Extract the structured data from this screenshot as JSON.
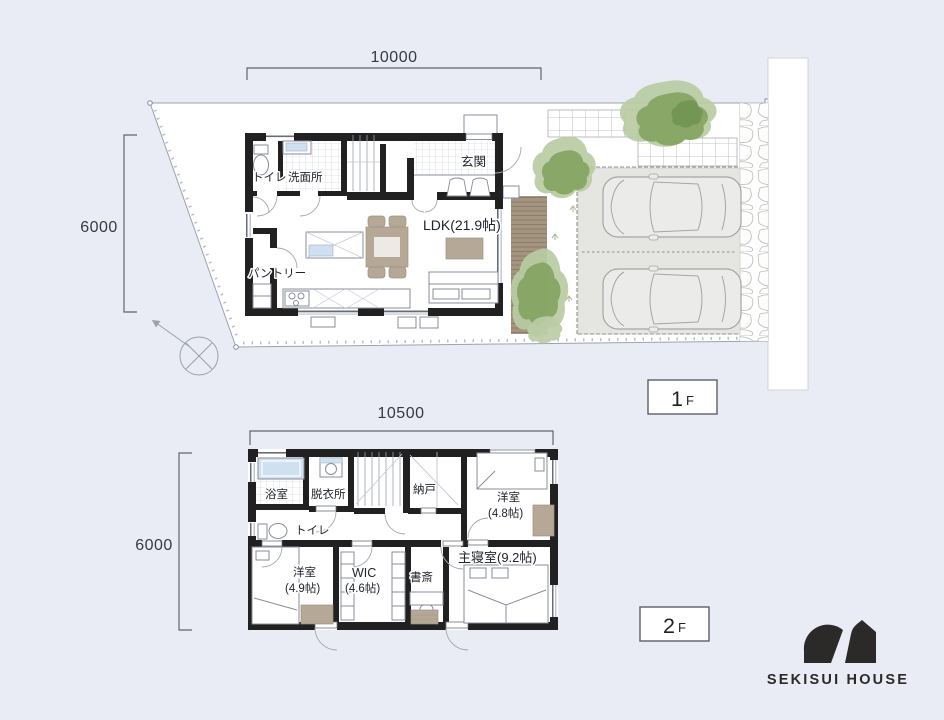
{
  "colors": {
    "background": "#e9ecf4",
    "site": "#ffffff",
    "wall": "#212121",
    "furniture_tan": "#b6a896",
    "water_blue": "#cfe0f0",
    "tree_light": "#b9cba3",
    "tree_dark": "#83a35f",
    "driveway_grey": "#e5e6e2",
    "deck_brown": "#a39580",
    "logo_black": "#2b2a28"
  },
  "floor1": {
    "badge_num": "1",
    "badge_suffix": "F",
    "dim_top": "10000",
    "dim_left": "6000",
    "rooms": {
      "toilet": "トイレ",
      "washroom": "洗面所",
      "entrance": "玄関",
      "ldk": "LDK(21.9帖)",
      "pantry": "パントリー"
    }
  },
  "floor2": {
    "badge_num": "2",
    "badge_suffix": "F",
    "dim_top": "10500",
    "dim_left": "6000",
    "rooms": {
      "bathroom": "浴室",
      "dressing_room": "脱衣所",
      "toilet": "トイレ",
      "storage": "納戸",
      "bedroom_a_name": "洋室",
      "bedroom_a_size": "(4.8帖)",
      "bedroom_b_name": "洋室",
      "bedroom_b_size": "(4.9帖)",
      "wic_name": "WIC",
      "wic_size": "(4.6帖)",
      "study": "書斎",
      "master_bedroom": "主寝室(9.2帖)"
    }
  },
  "brand": {
    "name": "SEKISUI HOUSE"
  },
  "icons": {
    "compass": "north-compass-icon",
    "tree": "tree-icon",
    "car": "car-icon",
    "logo_mark": "sekisui-house-logo-icon"
  }
}
